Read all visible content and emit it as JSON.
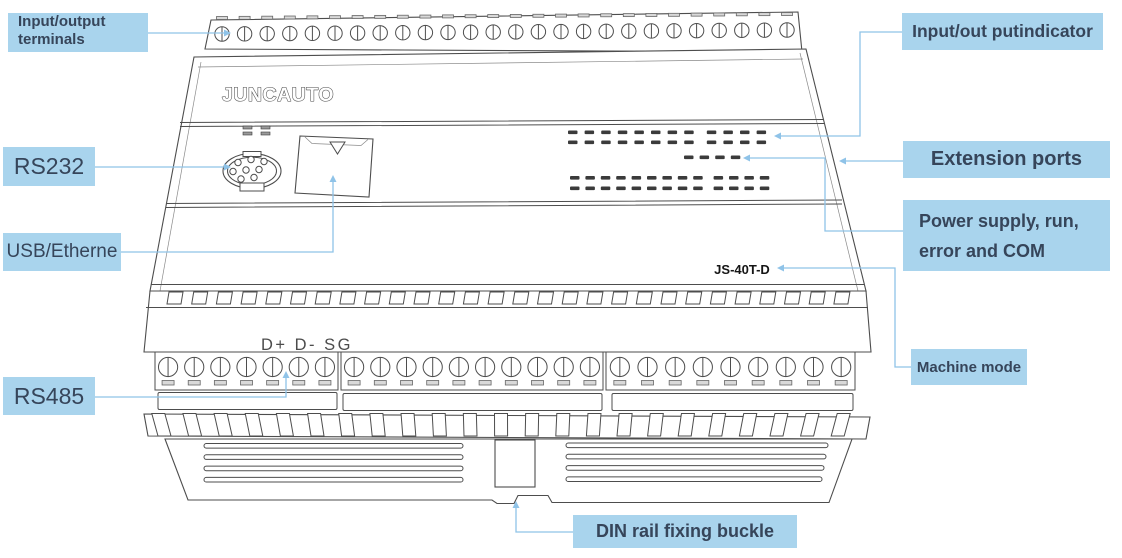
{
  "theme": {
    "label_bg": "#A9D4ED",
    "leader": "#8FC3E8",
    "label_text": "#36455A",
    "line": "#4D4D4D"
  },
  "device": {
    "brand_logo": "JUNCAUTO",
    "model": "JS-40T-D",
    "rs485_pins": "D+ D- SG",
    "structure": {
      "top_terminal_count": 26,
      "mid_vent_square_count": 28,
      "slant_vent_slot_count": 23,
      "lower_terminal_blocks": [
        7,
        10,
        9
      ],
      "io_led_rows": 2,
      "io_led_per_row": 12,
      "status_led_count": 4,
      "lower_led_rows": 2,
      "lower_led_per_row": 13,
      "side_vent_line_count": 4
    }
  },
  "callouts": {
    "input_output_terminals": {
      "line1": "Input/output",
      "line2": "terminals"
    },
    "rs232": {
      "label": "RS232"
    },
    "usb_etherne": {
      "label": "USB/Etherne"
    },
    "rs485": {
      "label": "RS485"
    },
    "input_out_putindicator": {
      "label": "Input/out putindicator"
    },
    "extension_ports": {
      "label": "Extension ports"
    },
    "power_supply": {
      "line1": "Power supply, run,",
      "line2": "error and COM"
    },
    "machine_mode": {
      "label": "Machine mode"
    },
    "din_rail": {
      "label": "DIN rail fixing buckle"
    }
  }
}
